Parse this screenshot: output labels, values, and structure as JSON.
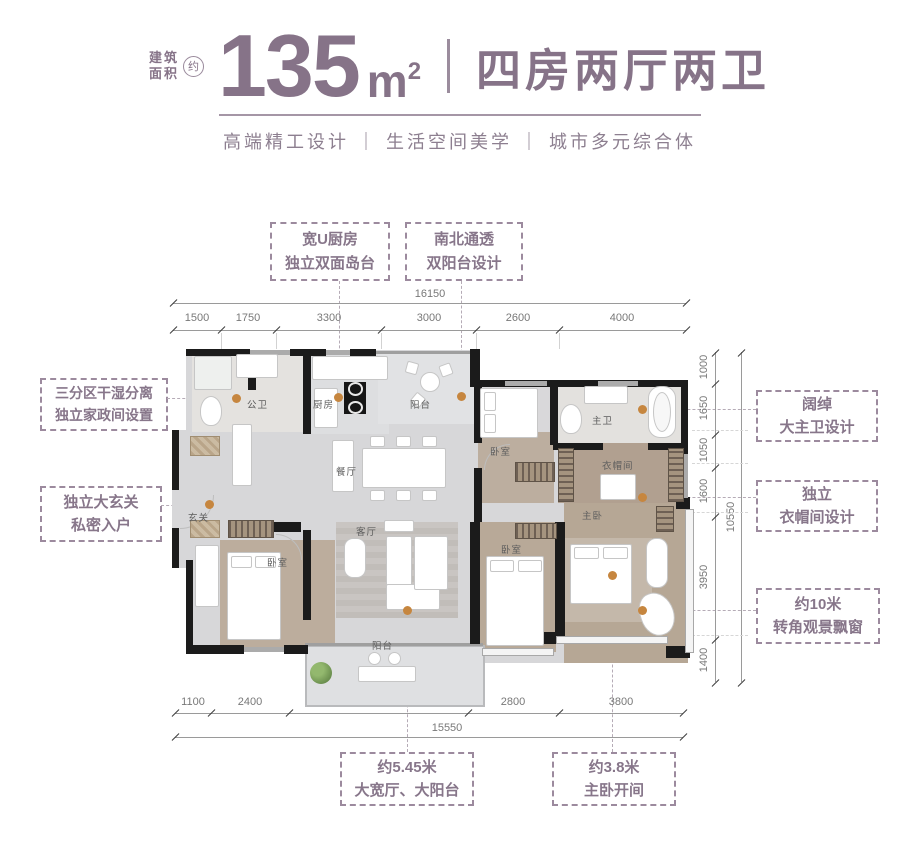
{
  "header": {
    "area_caption_line1": "建筑",
    "area_caption_line2": "面积",
    "approx_badge": "约",
    "area_value": "135",
    "area_unit": "m",
    "area_unit_sup": "2",
    "type_text": "四房两厅两卫",
    "subtitle": "高端精工设计 ｜ 生活空间美学 ｜ 城市多元综合体"
  },
  "callouts": {
    "kitchen": {
      "line1": "宽U厨房",
      "line2": "独立双面岛台"
    },
    "dual_balcony": {
      "line1": "南北通透",
      "line2": "双阳台设计"
    },
    "wet_dry": {
      "line1": "三分区干湿分离",
      "line2": "独立家政间设置"
    },
    "foyer": {
      "line1": "独立大玄关",
      "line2": "私密入户"
    },
    "master_bath": {
      "line1": "阔绰",
      "line2": "大主卫设计"
    },
    "cloakroom": {
      "line1": "独立",
      "line2": "衣帽间设计"
    },
    "bay_window": {
      "line1": "约10米",
      "line2": "转角观景飘窗"
    },
    "wide_hall": {
      "line1": "约5.45米",
      "line2": "大宽厅、大阳台"
    },
    "master_span": {
      "line1": "约3.8米",
      "line2": "主卧开间"
    }
  },
  "dimensions": {
    "top": {
      "total": "16150",
      "segments": [
        "1500",
        "1750",
        "3300",
        "3000",
        "2600",
        "4000"
      ]
    },
    "bottom": {
      "total": "15550",
      "segments": [
        "1100",
        "2400",
        "5450",
        "2800",
        "3800"
      ]
    },
    "right": {
      "total": "10550",
      "segments": [
        "1000",
        "1650",
        "1050",
        "1600",
        "3950",
        "1400"
      ]
    }
  },
  "rooms": {
    "guest_bath": "公卫",
    "kitchen": "厨房",
    "north_balcony": "阳台",
    "dining": "餐厅",
    "foyer": "玄关",
    "bedroom_a": "卧室",
    "living": "客厅",
    "south_balcony": "阳台",
    "bedroom_b": "卧室",
    "bedroom_c": "卧室",
    "master_bath": "主卫",
    "cloakroom": "衣帽间",
    "master_bedroom": "主卧"
  },
  "colors": {
    "accent": "#867388",
    "marker_dot": "#c6863f"
  }
}
